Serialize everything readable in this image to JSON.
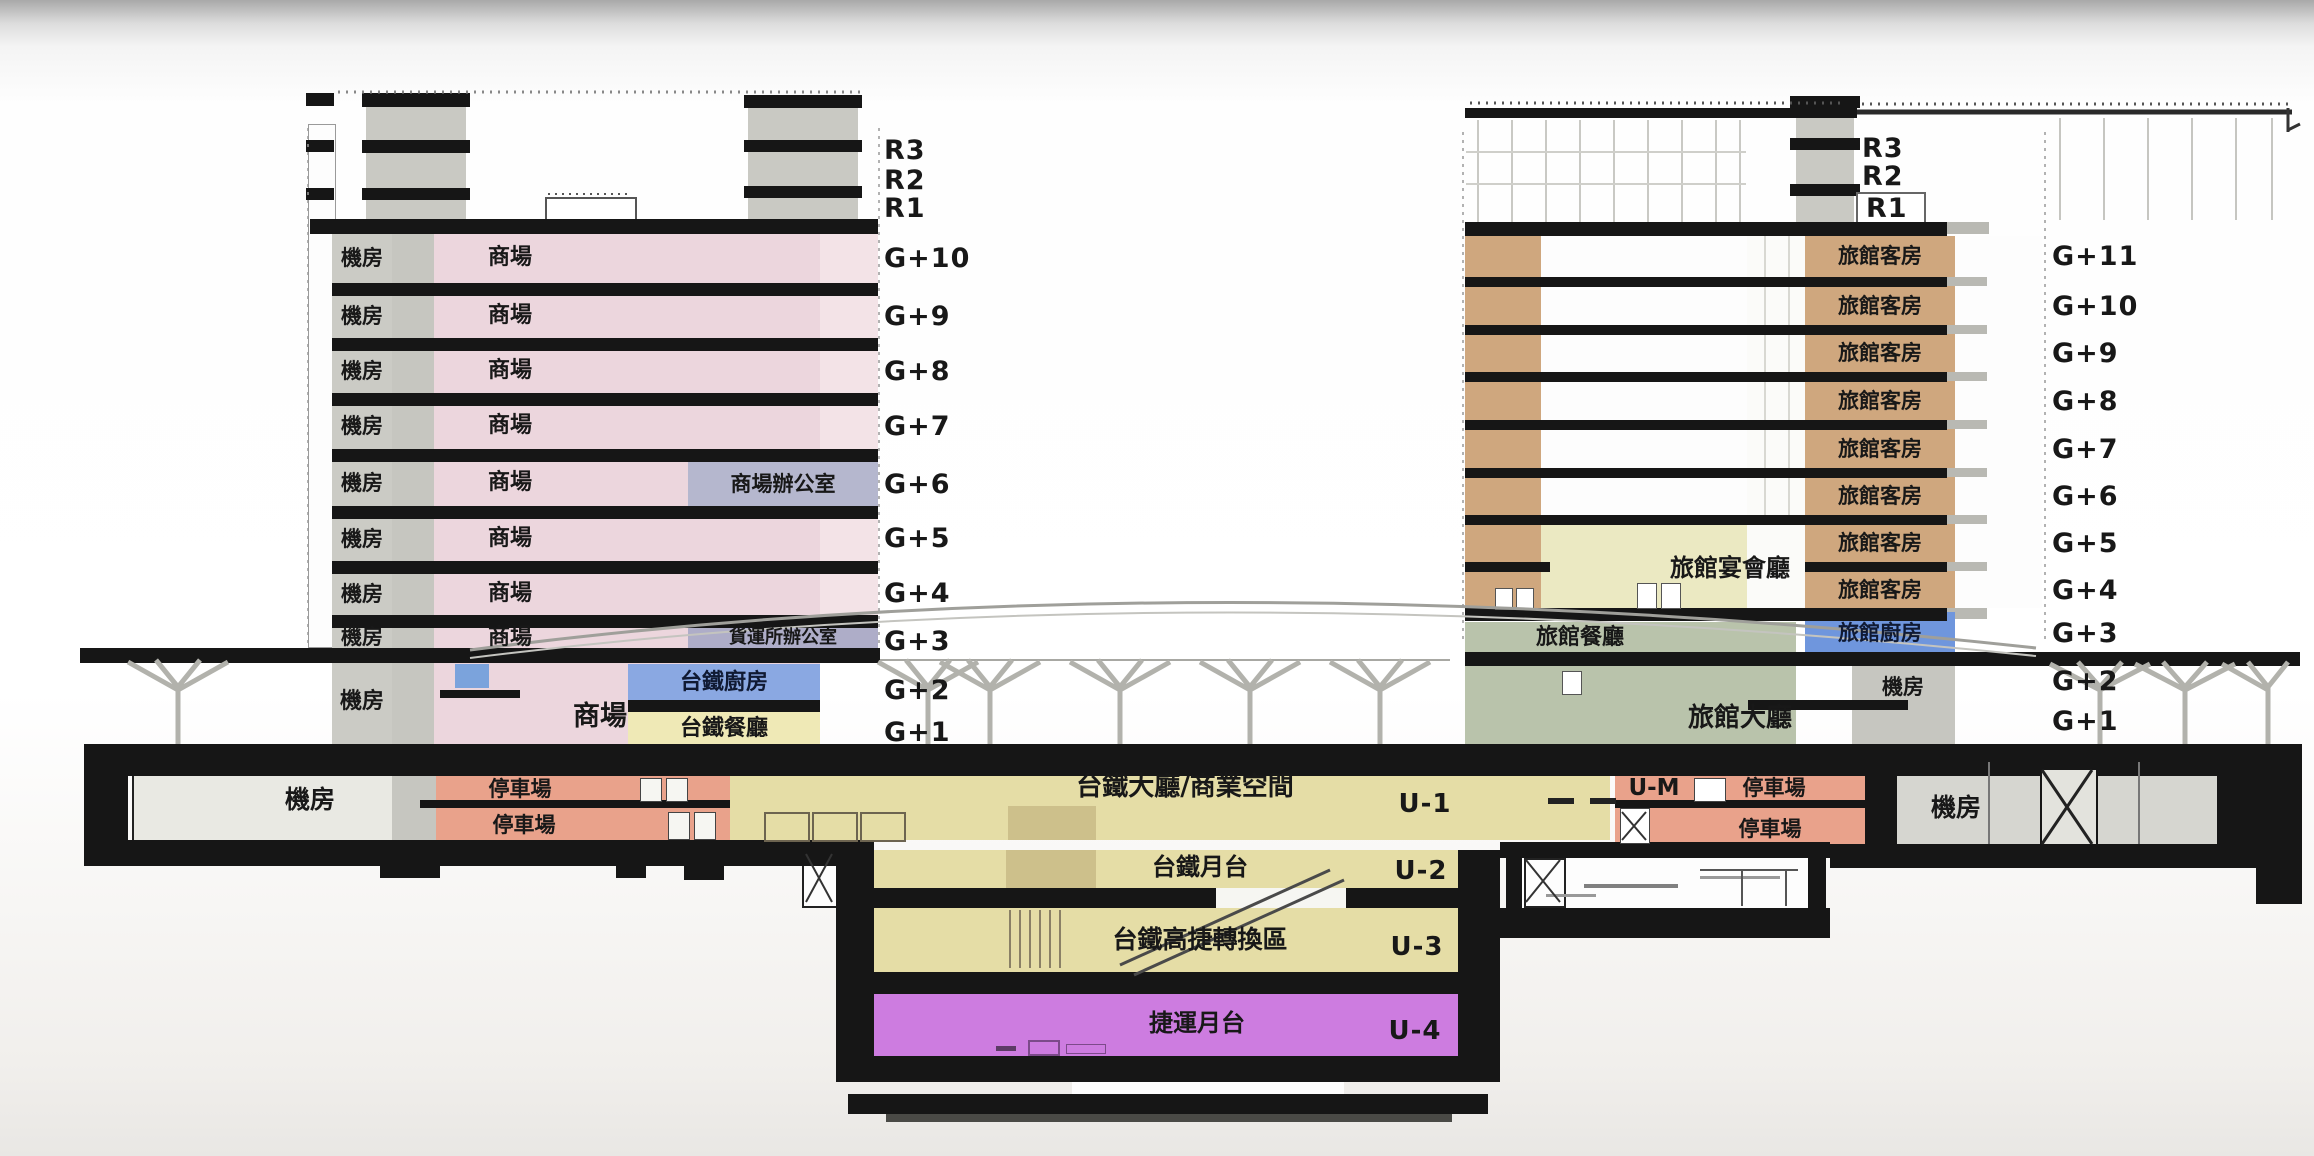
{
  "scene": {
    "type": "station-cross-section-diagram"
  },
  "colors": {
    "slab_black": "#161616",
    "mall_pink": "#ecd6dd",
    "machine_gray": "#cbcbc5",
    "hotel_tan": "#cfa77e",
    "banquet_yellow": "#ebe9c2",
    "lobby_green": "#b9c3ab",
    "tra_kitchen_blue": "#8aa8e2",
    "hotel_kitchen_blue": "#6f96dd",
    "office_blue": "#b5b7ce",
    "hall_yellow": "#e5dda6",
    "parking_salmon": "#e9a28b",
    "mrt_purple": "#cd7ce0",
    "restaurant_yellow": "#efe9b6"
  },
  "left_tower": {
    "floor_labels": [
      "R3",
      "R2",
      "R1",
      "G+10",
      "G+9",
      "G+8",
      "G+7",
      "G+6",
      "G+5",
      "G+4",
      "G+3",
      "G+2",
      "G+1"
    ],
    "machine_room": "機房",
    "mall": "商場",
    "mall_office": "商場辦公室",
    "freight_office": "貨運所辦公室",
    "tra_kitchen": "台鐵廚房",
    "tra_restaurant": "台鐵餐廳"
  },
  "right_tower": {
    "roof_labels": [
      "R3",
      "R2",
      "R1"
    ],
    "floor_labels": [
      "G+11",
      "G+10",
      "G+9",
      "G+8",
      "G+7",
      "G+6",
      "G+5",
      "G+4",
      "G+3",
      "G+2",
      "G+1"
    ],
    "guest_room": "旅館客房",
    "banquet_hall": "旅館宴會廳",
    "restaurant": "旅館餐廳",
    "kitchen": "旅館廚房",
    "machine_room": "機房",
    "lobby": "旅館大廳"
  },
  "underground": {
    "levels": [
      {
        "code": "U-1",
        "name": "台鐵大廳/商業空間"
      },
      {
        "code": "U-2",
        "name": "台鐵月台"
      },
      {
        "code": "U-3",
        "name": "台鐵高捷轉換區"
      },
      {
        "code": "U-4",
        "name": "捷運月台"
      }
    ],
    "mezzanine_code": "U-M",
    "parking": "停車場",
    "machine_room": "機房"
  }
}
